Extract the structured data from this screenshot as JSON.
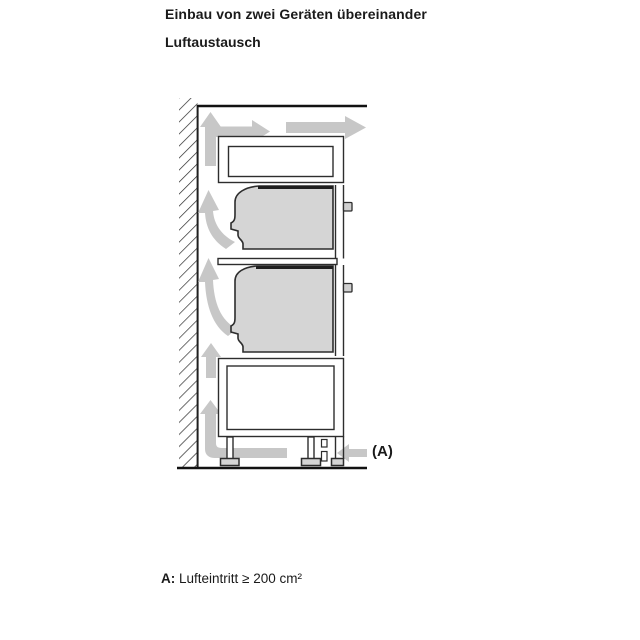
{
  "header": {
    "title": "Einbau von zwei Geräten übereinander",
    "subtitle": "Luftaustausch"
  },
  "diagram": {
    "label_a": "(A)",
    "description": "Side view of two built-in ovens stacked in a tall cabinet with airflow arrows",
    "colors": {
      "arrow_gray": "#c7c7c7",
      "appliance_fill": "#d5d5d5",
      "outline": "#2d2d2d",
      "heavy_line": "#111111"
    }
  },
  "caption": {
    "label": "A:",
    "text": "Lufteintritt ≥ 200 cm²"
  }
}
